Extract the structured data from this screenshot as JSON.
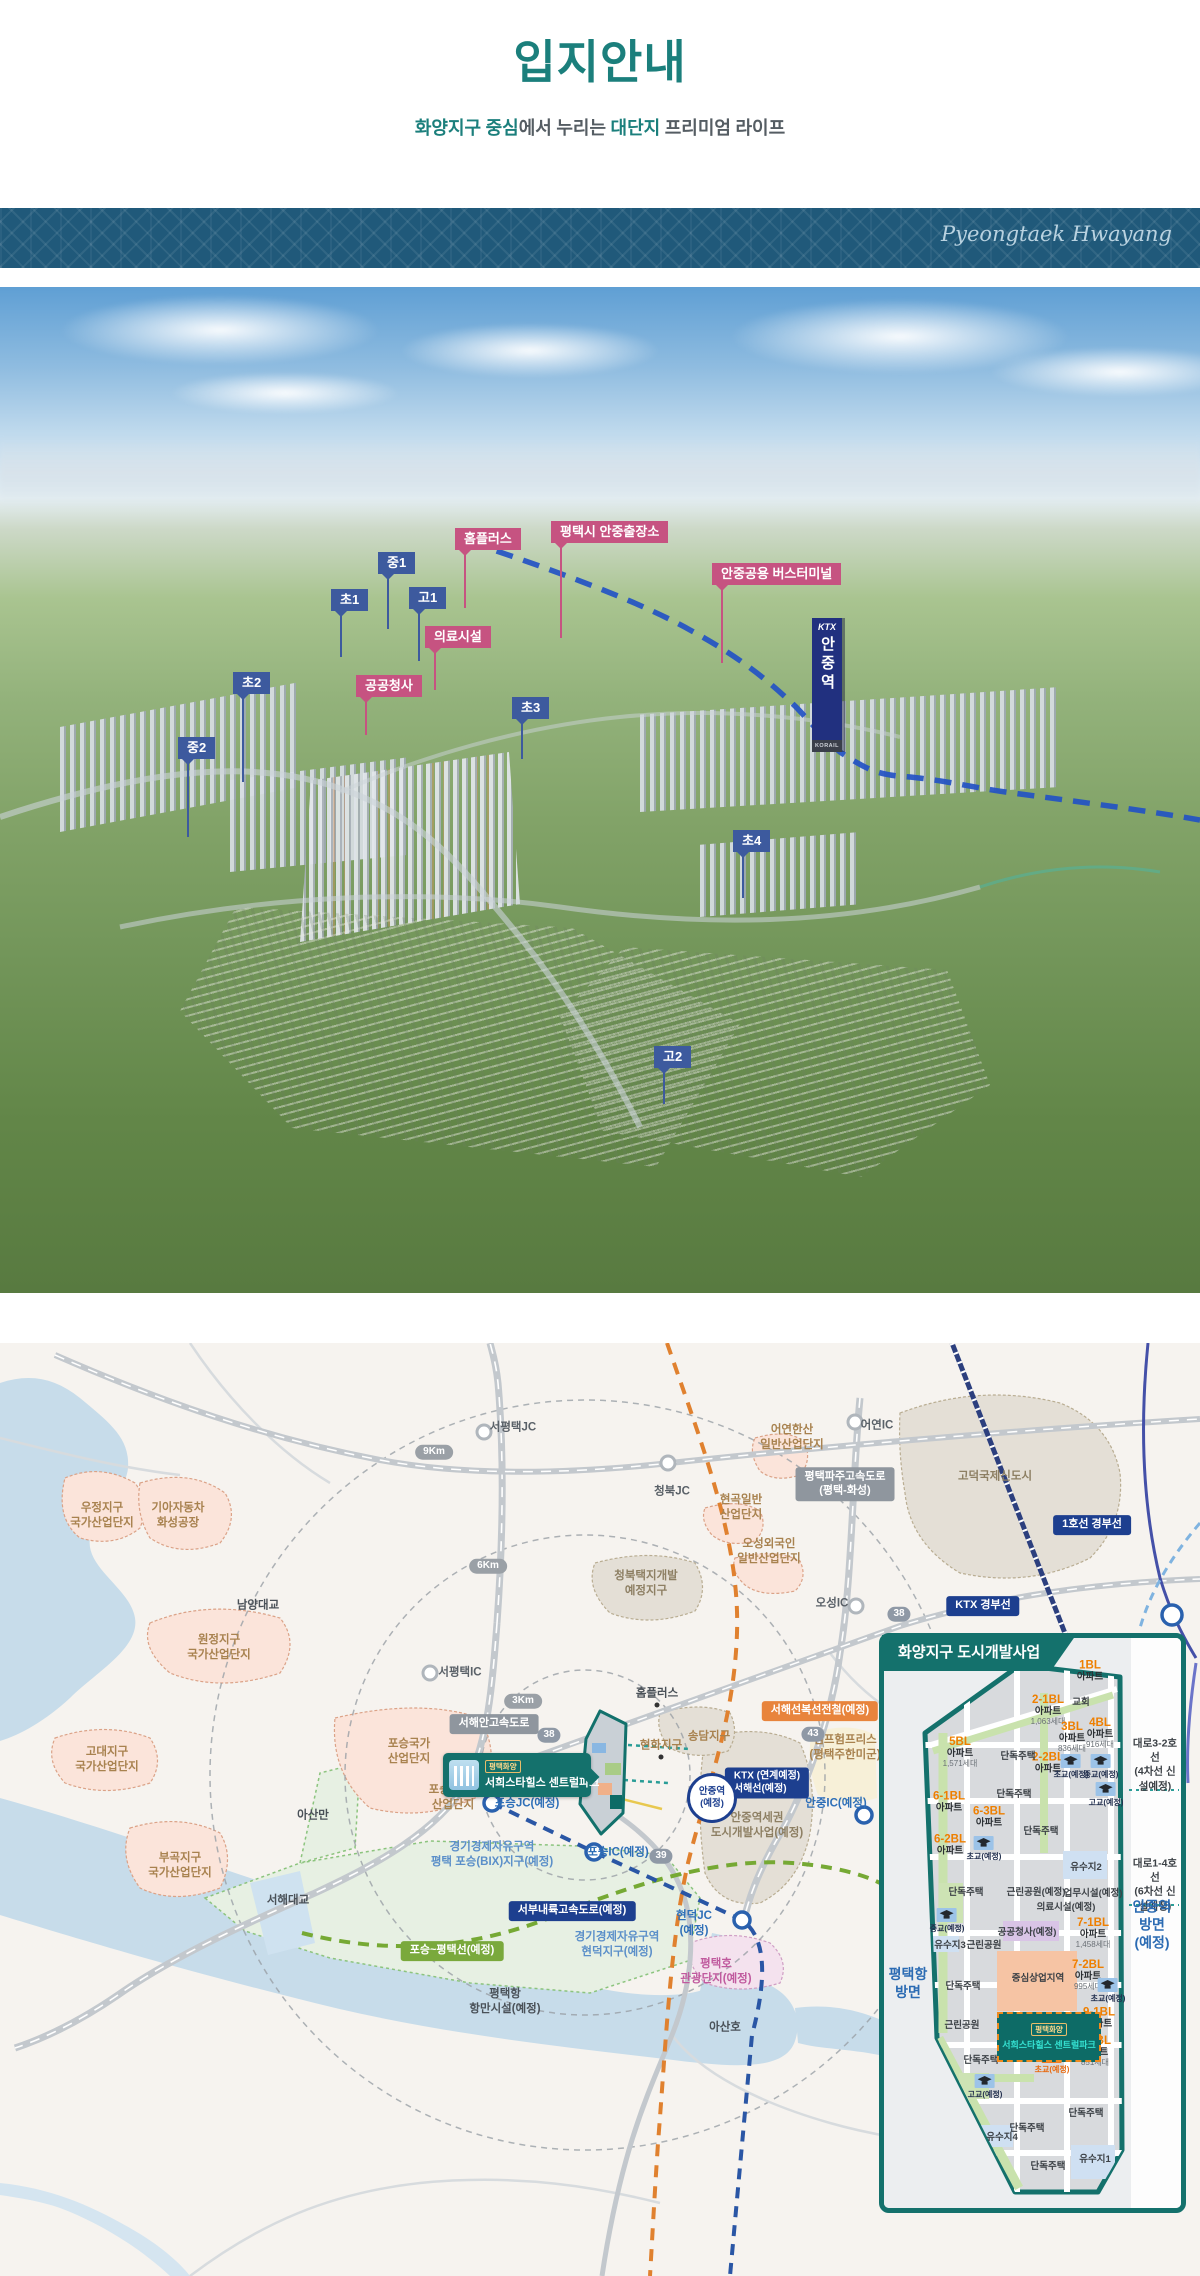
{
  "page": {
    "title": "입지안내",
    "subtitle": {
      "p1": "화양지구 중심",
      "p2": "에서 누리는 ",
      "p3": "대단지",
      "p4": " 프리미엄 라이프"
    },
    "accent_color": "#1b7f7c"
  },
  "banner": {
    "script_text": "Pyeongtaek Hwayang",
    "bg_color": "#20597a"
  },
  "aerial": {
    "station": {
      "brand": "KTX",
      "name": "안중역",
      "operator": "KORAIL"
    },
    "labels": [
      {
        "text": "홈플러스",
        "type": "pink",
        "x": 455,
        "y": 241,
        "tail": 58
      },
      {
        "text": "평택시 안중출장소",
        "type": "pink",
        "x": 551,
        "y": 234,
        "tail": 95
      },
      {
        "text": "안중공용 버스터미널",
        "type": "pink",
        "x": 712,
        "y": 276,
        "tail": 78
      },
      {
        "text": "의료시설",
        "type": "pink",
        "x": 425,
        "y": 339,
        "tail": 42
      },
      {
        "text": "공공청사",
        "type": "pink",
        "x": 356,
        "y": 388,
        "tail": 38
      },
      {
        "text": "중1",
        "type": "blue",
        "x": 378,
        "y": 265,
        "tail": 55
      },
      {
        "text": "초1",
        "type": "blue",
        "x": 331,
        "y": 302,
        "tail": 46
      },
      {
        "text": "고1",
        "type": "blue",
        "x": 409,
        "y": 300,
        "tail": 52
      },
      {
        "text": "초2",
        "type": "blue",
        "x": 233,
        "y": 385,
        "tail": 88
      },
      {
        "text": "중2",
        "type": "blue",
        "x": 178,
        "y": 450,
        "tail": 78
      },
      {
        "text": "초3",
        "type": "blue",
        "x": 512,
        "y": 410,
        "tail": 40
      },
      {
        "text": "초4",
        "type": "blue",
        "x": 733,
        "y": 543,
        "tail": 46
      },
      {
        "text": "고2",
        "type": "blue",
        "x": 654,
        "y": 759,
        "tail": 36
      }
    ]
  },
  "map": {
    "labels": [
      {
        "text": "우정지구\n국가산업단지",
        "type": "zone",
        "x": 102,
        "y": 173
      },
      {
        "text": "기아자동차\n화성공장",
        "type": "zone",
        "x": 178,
        "y": 173
      },
      {
        "text": "원정지구\n국가산업단지",
        "type": "zone",
        "x": 219,
        "y": 305
      },
      {
        "text": "고대지구\n국가산업단지",
        "type": "zone",
        "x": 107,
        "y": 417
      },
      {
        "text": "부곡지구\n국가산업단지",
        "type": "zone",
        "x": 180,
        "y": 523
      },
      {
        "text": "포승국가\n산업단지",
        "type": "zone",
        "x": 409,
        "y": 409
      },
      {
        "text": "포승2일반\n산업단지",
        "type": "zone",
        "x": 453,
        "y": 455
      },
      {
        "text": "어연한산\n일반산업단지",
        "type": "zone",
        "x": 792,
        "y": 95
      },
      {
        "text": "현곡일반\n산업단지",
        "type": "zone",
        "x": 741,
        "y": 165
      },
      {
        "text": "오성외국인\n일반산업단지",
        "type": "zone",
        "x": 769,
        "y": 209
      },
      {
        "text": "캠프험프리스\n(평택주한미군)",
        "type": "zone",
        "x": 845,
        "y": 405
      },
      {
        "text": "현화지구",
        "type": "zone",
        "x": 661,
        "y": 403
      },
      {
        "text": "송담지구",
        "type": "zone",
        "x": 709,
        "y": 394
      },
      {
        "text": "고덕국제신도시",
        "type": "dev",
        "x": 995,
        "y": 134
      },
      {
        "text": "청북택지개발\n예정지구",
        "type": "dev",
        "x": 646,
        "y": 241
      },
      {
        "text": "안중역세권\n도시개발사업(예정)",
        "type": "dev",
        "x": 757,
        "y": 483
      },
      {
        "text": "남양대교",
        "type": "place",
        "x": 258,
        "y": 263
      },
      {
        "text": "서해대교",
        "type": "place",
        "x": 288,
        "y": 558
      },
      {
        "text": "아산만",
        "type": "place",
        "x": 313,
        "y": 473
      },
      {
        "text": "아산호",
        "type": "place",
        "x": 725,
        "y": 685
      },
      {
        "text": "홈플러스",
        "type": "place",
        "x": 657,
        "y": 351
      },
      {
        "text": "평택항\n항만시설(예정)",
        "type": "place",
        "x": 505,
        "y": 659
      },
      {
        "text": "서평택JC",
        "type": "ic",
        "x": 513,
        "y": 85
      },
      {
        "text": "청북JC",
        "type": "ic",
        "x": 672,
        "y": 149
      },
      {
        "text": "어연IC",
        "type": "ic",
        "x": 877,
        "y": 83
      },
      {
        "text": "오성IC",
        "type": "ic",
        "x": 832,
        "y": 261
      },
      {
        "text": "서평택IC",
        "type": "ic",
        "x": 460,
        "y": 330
      },
      {
        "text": "포승JC(예정)",
        "type": "icblue",
        "x": 527,
        "y": 461
      },
      {
        "text": "포승IC(예정)",
        "type": "icblue",
        "x": 618,
        "y": 510
      },
      {
        "text": "안중IC(예정)",
        "type": "icblue",
        "x": 836,
        "y": 461
      },
      {
        "text": "현덕JC\n(예정)",
        "type": "icblue",
        "x": 694,
        "y": 581
      },
      {
        "text": "경기경제자유구역\n평택 포승(BIX)지구(예정)",
        "type": "bluezone",
        "x": 492,
        "y": 512
      },
      {
        "text": "경기경제자유구역\n현덕지구(예정)",
        "type": "bluezone",
        "x": 617,
        "y": 602
      },
      {
        "text": "평택호\n관광단지(예정)",
        "type": "pinkzone",
        "x": 716,
        "y": 629
      }
    ],
    "badges": [
      {
        "text": "서해안고속도로",
        "type": "bgray",
        "x": 494,
        "y": 381
      },
      {
        "text": "평택파주고속도로\n(평택-화성)",
        "type": "bgray",
        "x": 845,
        "y": 141
      },
      {
        "text": "KTX 경부선",
        "type": "bnavy",
        "x": 983,
        "y": 263
      },
      {
        "text": "1호선 경부선",
        "type": "bnavy",
        "x": 1092,
        "y": 182
      },
      {
        "text": "서부내륙고속도로(예정)",
        "type": "bnavy",
        "x": 572,
        "y": 568
      },
      {
        "text": "KTX (연계예정)\n서해선(예정)",
        "type": "bnavy2",
        "x": 767,
        "y": 440
      },
      {
        "text": "서해선복선전철(예정)",
        "type": "borange",
        "x": 820,
        "y": 368
      },
      {
        "text": "포승~평택선(예정)",
        "type": "bgreen",
        "x": 452,
        "y": 608
      },
      {
        "text": "9Km",
        "type": "pill",
        "x": 434,
        "y": 109
      },
      {
        "text": "6Km",
        "type": "pill",
        "x": 488,
        "y": 223
      },
      {
        "text": "3Km",
        "type": "pill",
        "x": 523,
        "y": 358
      },
      {
        "text": "38",
        "type": "route",
        "x": 899,
        "y": 271
      },
      {
        "text": "38",
        "type": "route",
        "x": 549,
        "y": 392
      },
      {
        "text": "39",
        "type": "route",
        "x": 661,
        "y": 513
      },
      {
        "text": "43",
        "type": "route",
        "x": 813,
        "y": 391
      },
      {
        "text": "안중역\n(예정)",
        "type": "stcirc",
        "x": 712,
        "y": 455
      }
    ],
    "callout": {
      "tag": "평택화양",
      "name": "서희스타힐스 센트럴파크"
    }
  },
  "panel": {
    "header": "화양지구 도시개발사업",
    "site": {
      "tag": "평택화양",
      "name": "서희스타힐스 센트럴파크"
    },
    "blocks": [
      {
        "n": "1BL",
        "t": "아파트",
        "u": "",
        "x": 1090,
        "y": 328
      },
      {
        "n": "2-1BL",
        "t": "아파트",
        "u": "1,063세대",
        "x": 1048,
        "y": 367
      },
      {
        "n": "3BL",
        "t": "아파트",
        "u": "836세대",
        "x": 1072,
        "y": 394
      },
      {
        "n": "4BL",
        "t": "아파트",
        "u": "916세대",
        "x": 1100,
        "y": 390
      },
      {
        "n": "5BL",
        "t": "아파트",
        "u": "1,571세대",
        "x": 960,
        "y": 409
      },
      {
        "n": "2-2BL",
        "t": "아파트",
        "u": "",
        "x": 1048,
        "y": 420
      },
      {
        "n": "6-1BL",
        "t": "아파트",
        "u": "",
        "x": 949,
        "y": 459
      },
      {
        "n": "6-3BL",
        "t": "아파트",
        "u": "",
        "x": 989,
        "y": 474
      },
      {
        "n": "6-2BL",
        "t": "아파트",
        "u": "",
        "x": 950,
        "y": 502
      },
      {
        "n": "7-1BL",
        "t": "아파트",
        "u": "1,458세대",
        "x": 1093,
        "y": 590
      },
      {
        "n": "7-2BL",
        "t": "아파트",
        "u": "995세대",
        "x": 1088,
        "y": 632
      },
      {
        "n": "9-1BL",
        "t": "아파트",
        "u": "",
        "x": 1099,
        "y": 675
      },
      {
        "n": "9-2BL",
        "t": "아파트",
        "u": "851세대",
        "x": 1095,
        "y": 708
      }
    ],
    "plains": [
      {
        "text": "교회",
        "x": 1081,
        "y": 358
      },
      {
        "text": "단독주택",
        "x": 1018,
        "y": 412
      },
      {
        "text": "단독주택",
        "x": 1014,
        "y": 450
      },
      {
        "text": "단독주택",
        "x": 1041,
        "y": 487
      },
      {
        "text": "단독주택",
        "x": 966,
        "y": 548
      },
      {
        "text": "단독주택",
        "x": 963,
        "y": 642
      },
      {
        "text": "단독주택",
        "x": 981,
        "y": 716
      },
      {
        "text": "단독주택",
        "x": 1086,
        "y": 769
      },
      {
        "text": "단독주택",
        "x": 1027,
        "y": 784
      },
      {
        "text": "단독주택",
        "x": 1048,
        "y": 822
      },
      {
        "text": "근린공원(예정)",
        "x": 1036,
        "y": 548
      },
      {
        "text": "업무시설(예정)",
        "x": 1093,
        "y": 549
      },
      {
        "text": "의료시설(예정)",
        "x": 1066,
        "y": 563
      },
      {
        "text": "공공청사(예정)",
        "x": 1027,
        "y": 588
      },
      {
        "text": "근린공원",
        "x": 984,
        "y": 601
      },
      {
        "text": "유수지3",
        "x": 950,
        "y": 601
      },
      {
        "text": "중심상업지역",
        "x": 1038,
        "y": 634
      },
      {
        "text": "유수지2",
        "x": 1086,
        "y": 523
      },
      {
        "text": "근린공원",
        "x": 962,
        "y": 681
      },
      {
        "text": "유수지4",
        "x": 1002,
        "y": 793
      },
      {
        "text": "유수지1",
        "x": 1095,
        "y": 815
      }
    ],
    "schools": [
      {
        "text": "초교(예정)",
        "type": "blue",
        "x": 1071,
        "y": 424
      },
      {
        "text": "중교(예정)",
        "type": "blue",
        "x": 1101,
        "y": 424
      },
      {
        "text": "고교(예정)",
        "type": "blue",
        "x": 1106,
        "y": 452
      },
      {
        "text": "초교(예정)",
        "type": "blue",
        "x": 984,
        "y": 506
      },
      {
        "text": "중교(예정)",
        "type": "blue",
        "x": 947,
        "y": 578
      },
      {
        "text": "초교(예정)",
        "type": "blue",
        "x": 1108,
        "y": 648
      },
      {
        "text": "초교(예정)",
        "type": "orange",
        "x": 1052,
        "y": 719
      },
      {
        "text": "고교(예정)",
        "type": "blue",
        "x": 985,
        "y": 744
      }
    ],
    "roadnotes": [
      {
        "text": "대로3-2호선\n(4차선 신설예정)",
        "type": "note",
        "x": 1155,
        "y": 422
      },
      {
        "text": "대로1-4호선\n(6차선 신설예정)",
        "type": "note",
        "x": 1155,
        "y": 542
      },
      {
        "text": "안중역방면\n(예정)",
        "type": "notedir",
        "x": 1152,
        "y": 582
      },
      {
        "text": "평택항\n방면",
        "type": "notedir",
        "x": 908,
        "y": 640
      }
    ]
  }
}
